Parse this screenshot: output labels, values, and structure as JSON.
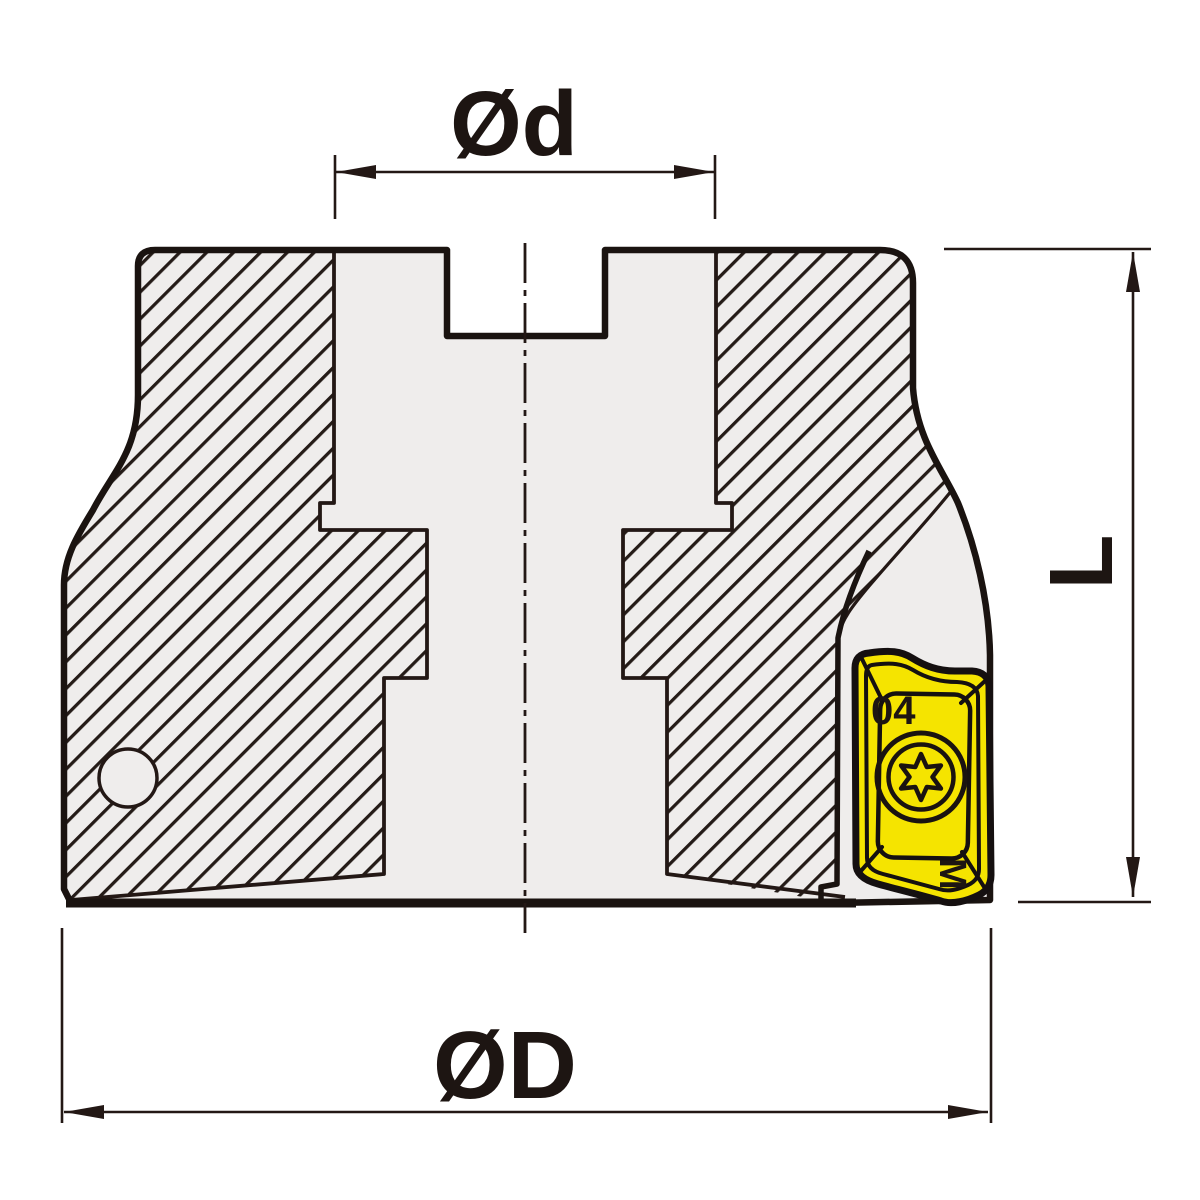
{
  "dimensions": {
    "top_diameter_label": "Ød",
    "outer_diameter_label": "ØD",
    "height_label": "L"
  },
  "insert": {
    "marking_top": "04",
    "marking_side": "M"
  },
  "colors": {
    "body_gray": "#efedec",
    "insert_yellow": "#f5e400",
    "line_dark": "#231815",
    "background_white": "#ffffff"
  }
}
